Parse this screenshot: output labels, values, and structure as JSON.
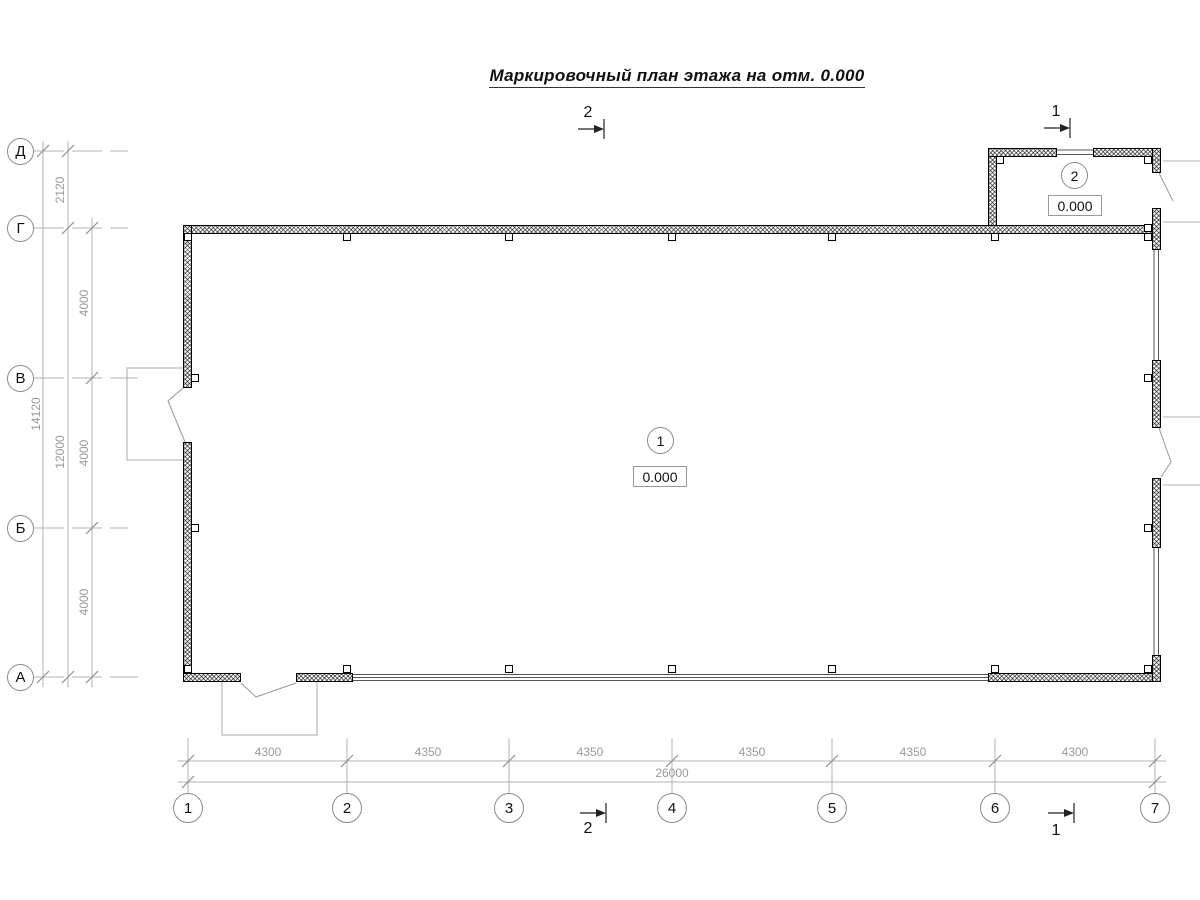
{
  "title": "Маркировочный план этажа на отм. 0.000",
  "axes": {
    "cols": [
      "1",
      "2",
      "3",
      "4",
      "5",
      "6",
      "7"
    ],
    "rows": [
      "Д",
      "Г",
      "В",
      "Б",
      "А"
    ]
  },
  "dims": {
    "bottom": {
      "segments": [
        "4300",
        "4350",
        "4350",
        "4350",
        "4350",
        "4300"
      ],
      "total": "26000"
    },
    "left": {
      "overall": "14120",
      "upper": "2120",
      "main": "12000",
      "segments": [
        "4000",
        "4000",
        "4000"
      ]
    }
  },
  "rooms": [
    {
      "number": "1",
      "elevation": "0.000"
    },
    {
      "number": "2",
      "elevation": "0.000"
    }
  ],
  "sections": [
    {
      "label": "2"
    },
    {
      "label": "1"
    }
  ]
}
